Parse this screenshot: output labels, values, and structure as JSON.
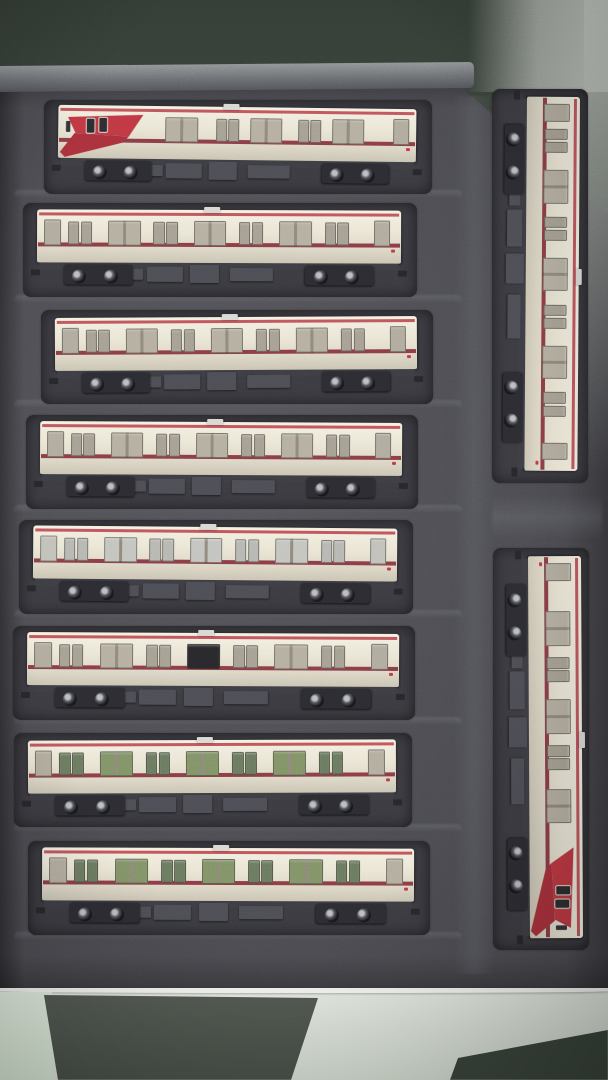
{
  "scene": {
    "description": "Overhead photo of ten N-scale model train cars stored in a dark gray foam case: eight cream cars with red stripes lying horizontally in rows on the left, and two cars placed vertically along the right edge; pale table surface visible at the bottom.",
    "counts": {
      "horizontal_cars": 8,
      "vertical_cars": 2,
      "total_cars": 10
    }
  },
  "palette": {
    "cream_hi": "#f4f0e1",
    "cream": "#eae5d3",
    "cream_lo": "#c9c3b1",
    "stripe_top": "#c04b53",
    "stripe_waist": "#8d3b46",
    "nose_red": "#c43540",
    "nose_red2": "#ad2f3a",
    "chassis": "#3c3c42",
    "box1": "#4c4c54",
    "bogie": "#2b2b31",
    "wheel_core": "#17171b",
    "wheel_shine": "#b9bcc2",
    "rooftab": "#d8d8d3",
    "tail": "#c13a42",
    "cab_glass": "#2c2c31",
    "cab_frame": "#ddd8c8"
  },
  "window_tints": {
    "tan": {
      "wide": "#b4ad9e",
      "pair": "#a59e90",
      "end": "#b0a99b"
    },
    "light": {
      "wide": "#c3c3be",
      "pair": "#b6b6b1",
      "end": "#c0bfb8"
    },
    "tan_dark": {
      "wide": "#b4ad9e",
      "pair": "#a59e90",
      "end": "#b0a99b",
      "dark_wide_index": 1,
      "dark": "#28282c"
    },
    "green": {
      "wide": "#7e9163",
      "pair": "#69785d",
      "end": "#b2ac9c"
    }
  },
  "window_layouts": {
    "mid": [
      {
        "t": "end",
        "x": 2
      },
      {
        "t": "pair",
        "x": 8.5
      },
      {
        "t": "wide",
        "x": 19.5
      },
      {
        "t": "pair",
        "x": 32
      },
      {
        "t": "wide",
        "x": 43
      },
      {
        "t": "pair",
        "x": 55.5
      },
      {
        "t": "wide",
        "x": 66.5
      },
      {
        "t": "pair",
        "x": 79
      },
      {
        "t": "end",
        "x": 92.5
      }
    ],
    "cab": [
      {
        "t": "wide",
        "x": 30
      },
      {
        "t": "pair",
        "x": 44
      },
      {
        "t": "wide",
        "x": 53.5
      },
      {
        "t": "pair",
        "x": 67
      },
      {
        "t": "wide",
        "x": 76.5
      },
      {
        "t": "end",
        "x": 93.5
      }
    ]
  },
  "cars": [
    {
      "name": "lead-car-row-1",
      "kind": "cab",
      "cab": "left",
      "orient": "h",
      "x": 58,
      "y": 107,
      "len": 358,
      "tint": "tan",
      "tilt": 0.7
    },
    {
      "name": "middle-car-row-2",
      "kind": "mid",
      "orient": "h",
      "x": 37,
      "y": 210,
      "len": 364,
      "tint": "tan",
      "tilt": 0.2
    },
    {
      "name": "middle-car-row-3",
      "kind": "mid",
      "orient": "h",
      "x": 55,
      "y": 317,
      "len": 362,
      "tint": "tan",
      "tilt": -0.3
    },
    {
      "name": "middle-car-row-4",
      "kind": "mid",
      "orient": "h",
      "x": 40,
      "y": 422,
      "len": 362,
      "tint": "tan",
      "tilt": 0.3
    },
    {
      "name": "middle-car-row-5",
      "kind": "mid",
      "orient": "h",
      "x": 33,
      "y": 527,
      "len": 364,
      "tint": "light",
      "tilt": 0.5
    },
    {
      "name": "middle-car-row-6",
      "kind": "mid",
      "orient": "h",
      "x": 27,
      "y": 633,
      "len": 372,
      "tint": "tan_dark",
      "tilt": 0.3
    },
    {
      "name": "middle-car-row-7",
      "kind": "mid",
      "orient": "h",
      "x": 28,
      "y": 740,
      "len": 368,
      "tint": "green",
      "tilt": -0.2
    },
    {
      "name": "middle-car-row-8",
      "kind": "mid",
      "orient": "h",
      "x": 42,
      "y": 848,
      "len": 372,
      "tint": "green",
      "tilt": 0.2
    },
    {
      "name": "middle-car-right-top",
      "kind": "mid",
      "orient": "v",
      "x": 580,
      "y": 97,
      "len": 374,
      "tint": "tan",
      "tilt": 0.4
    },
    {
      "name": "lead-car-right-bottom",
      "kind": "cab",
      "cab": "right",
      "orient": "v",
      "x": 581,
      "y": 556,
      "len": 382,
      "tint": "tan",
      "tilt": -0.3
    }
  ],
  "foam_ridge_rows_y": [
    190,
    295,
    400,
    505,
    610,
    717,
    824,
    932
  ]
}
